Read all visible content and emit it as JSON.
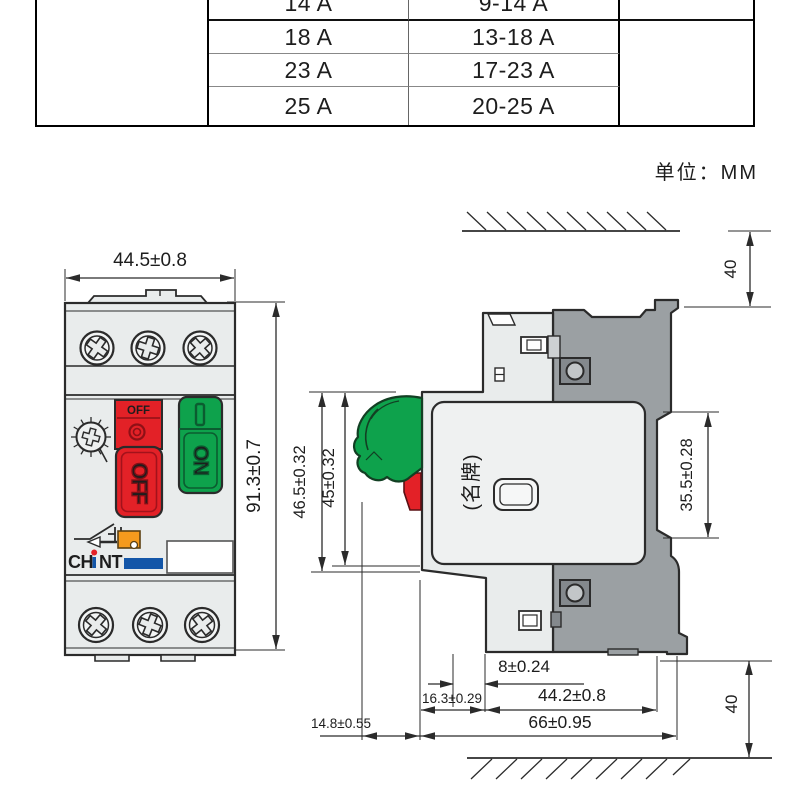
{
  "table": {
    "rows": [
      {
        "rated": "14 A",
        "range": "9-14 A"
      },
      {
        "rated": "18 A",
        "range": "13-18 A"
      },
      {
        "rated": "23 A",
        "range": "17-23 A"
      },
      {
        "rated": "25 A",
        "range": "20-25 A"
      }
    ]
  },
  "unit_note": "单位：MM",
  "front_view": {
    "dim_width": "44.5±0.8",
    "dim_height": "91.3±0.7",
    "off_label_top": "OFF",
    "off_button": "OFF",
    "on_button": "ON",
    "brand_left": "CH",
    "brand_right": "NT"
  },
  "side_view": {
    "nameplate": "(名牌)",
    "dims": {
      "clearance_top": "40",
      "clearance_bottom": "40",
      "d_46_5": "46.5±0.32",
      "d_45": "45±0.32",
      "d_35_5": "35.5±0.28",
      "d_8": "8±0.24",
      "d_16_3": "16.3±0.29",
      "d_44_2": "44.2±0.8",
      "d_14_8": "14.8±0.55",
      "d_66": "66±0.95"
    }
  },
  "colors": {
    "red": "#e32127",
    "green": "#0ea24c",
    "orange": "#f59a1d",
    "brand_blue": "#1356a8"
  }
}
